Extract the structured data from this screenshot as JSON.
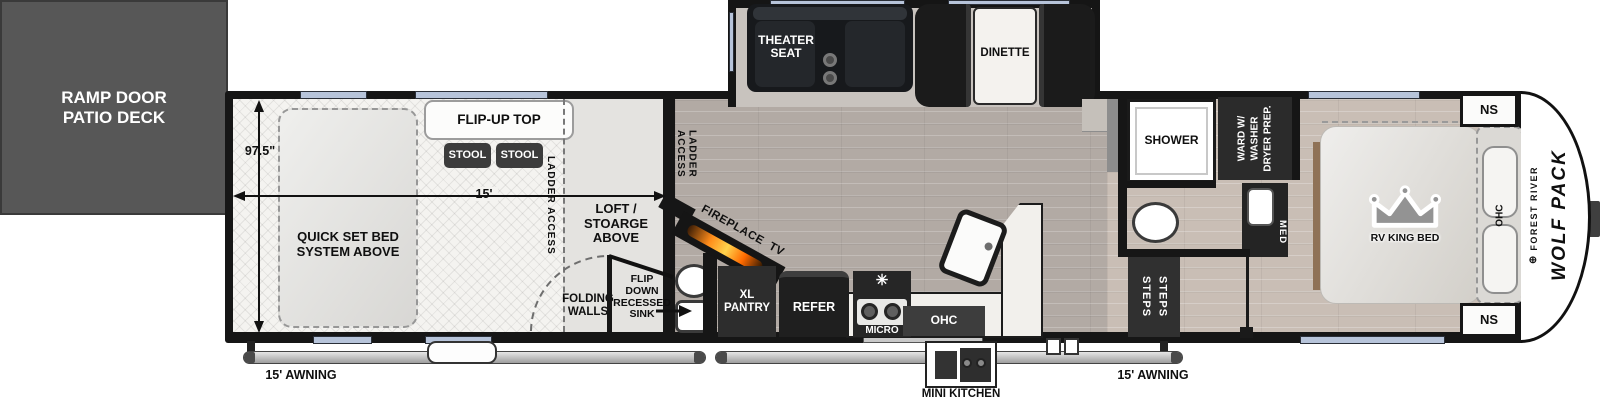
{
  "exterior": {
    "ramp_deck": "RAMP DOOR\nPATIO DECK",
    "awning_left": "15' AWNING",
    "awning_right": "15' AWNING",
    "mini_kitchen": "MINI KITCHEN",
    "brand_logo_glyph": "⊕",
    "brand_top": "FOREST RIVER",
    "brand_main": "WOLF PACK"
  },
  "garage": {
    "dim_width": "97.5\"",
    "dim_length": "15'",
    "flip_up_top": "FLIP-UP TOP",
    "stools": [
      "STOOL",
      "STOOL"
    ],
    "ladder_access_left": "LADDER ACCESS",
    "ladder_access_right": "LADDER ACCESS",
    "quick_set_bed": "QUICK SET BED\nSYSTEM ABOVE",
    "loft": "LOFT / STOARGE\nABOVE",
    "folding_walls": "FOLDING\nWALLS",
    "flip_sink": "FLIP\nDOWN\nRECESSED\nSINK"
  },
  "living": {
    "theater_seat": "THEATER\nSEAT",
    "dinette": "DINETTE",
    "fireplace_tv": "FIREPLACE  TV",
    "xl_pantry": "XL\nPANTRY",
    "refer": "REFER",
    "micro": "MICRO",
    "stove_glyph": "✳",
    "ohc": "OHC"
  },
  "bath": {
    "shower": "SHOWER",
    "ward": "WARD W/\nWASHER\nDRYER PREP.",
    "med": "MED",
    "steps": [
      "STEPS",
      "STEPS"
    ]
  },
  "bedroom": {
    "bed": "RV KING BED",
    "ohc": "OHC",
    "ns_top": "NS",
    "ns_bottom": "NS"
  },
  "colors": {
    "wall": "#161616",
    "window": "#b7c4da",
    "deck": "#575757",
    "floor_salon": "#b2aaa4",
    "floor_bedroom": "#c9beb5",
    "floor_garage": "#f4f3f0",
    "furniture_dark": "#2a2a2a",
    "flame_accent": "#f08a1d"
  }
}
